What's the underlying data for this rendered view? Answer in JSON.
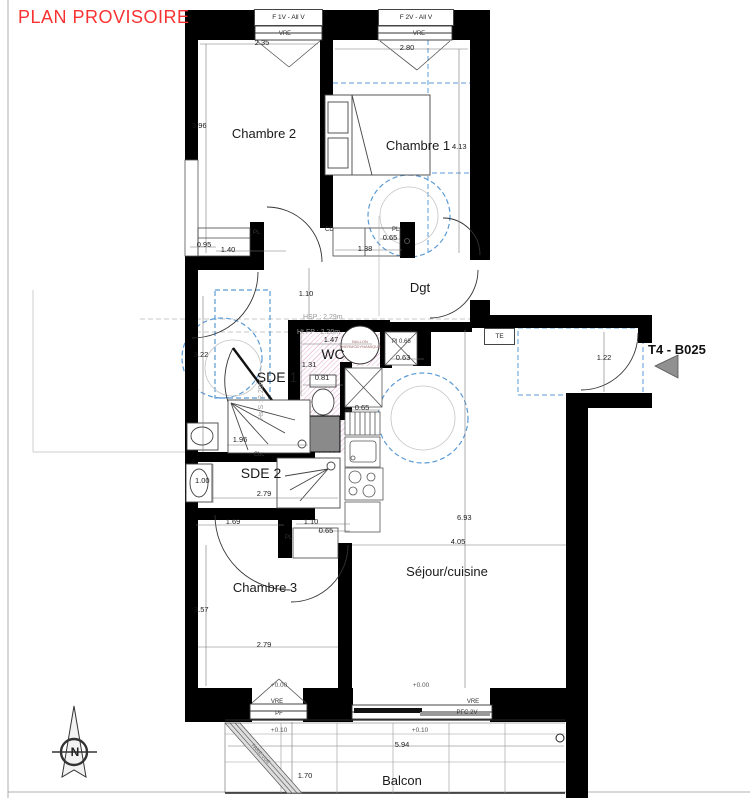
{
  "title": "PLAN PROVISOIRE",
  "unit": {
    "label": "T4 - B025"
  },
  "compass": {
    "north": "N"
  },
  "rooms": {
    "chambre2": "Chambre 2",
    "chambre1": "Chambre 1",
    "dgt": "Dgt",
    "wc": "WC",
    "sde1": "SDE 1",
    "sde2": "SDE 2",
    "chambre3": "Chambre 3",
    "sejour": "Séjour/cuisine",
    "balcon": "Balcon"
  },
  "windows": {
    "f1v": "F 1V - All V",
    "f2v": "F 2V - All V",
    "vre": "VRE",
    "pf": "PF",
    "pfc2v": "PFC 2V"
  },
  "labels": {
    "te": "TE",
    "pl": "PL",
    "cd": "CD",
    "cbc": "Cbc",
    "pl_066": "Pl 0.66",
    "ballon_line1": "BALLON",
    "ballon_line2": "THERMODYNAMIQUE",
    "hsp": "HSP : 2.29m",
    "ht_fp": "Ht FP : 2.20m",
    "hs_s": "Hs S : 2.20m",
    "pare_vue": "PARE-VUE"
  },
  "levels": {
    "l1": "+0.00",
    "l2": "+0.00",
    "l3": "+0.10",
    "l4": "+0.10"
  },
  "dims": {
    "w1": "2.35",
    "w2": "2.80",
    "c2_h": "3.96",
    "c1_h": "4.13",
    "c2_a": "0.95",
    "c2_b": "1.40",
    "c1_a": "0.65",
    "c1_b": "1.38",
    "dgt": "1.10",
    "sde1_w": "3.22",
    "wc_a": "1.47",
    "wc_b": "1.31",
    "wc_c": "0.81",
    "pl_a": "0.63",
    "kit": "0.65",
    "entry": "1.22",
    "sde1_sh": "1.96",
    "sde2_a": "1.00",
    "sde2_b": "2.79",
    "c3_a": "1.69",
    "c3_b": "1.10",
    "c3_c": "0.65",
    "sej_h": "6.93",
    "sej_w": "4.05",
    "c3_h": "3.57",
    "c3_w": "2.79",
    "balc_w": "5.94",
    "balc_h": "1.70"
  },
  "colors": {
    "accent_red": "#f93232",
    "dash_blue": "#5b9bd5",
    "hatch_pink": "#dd9ec4",
    "wall_black": "#000000"
  }
}
